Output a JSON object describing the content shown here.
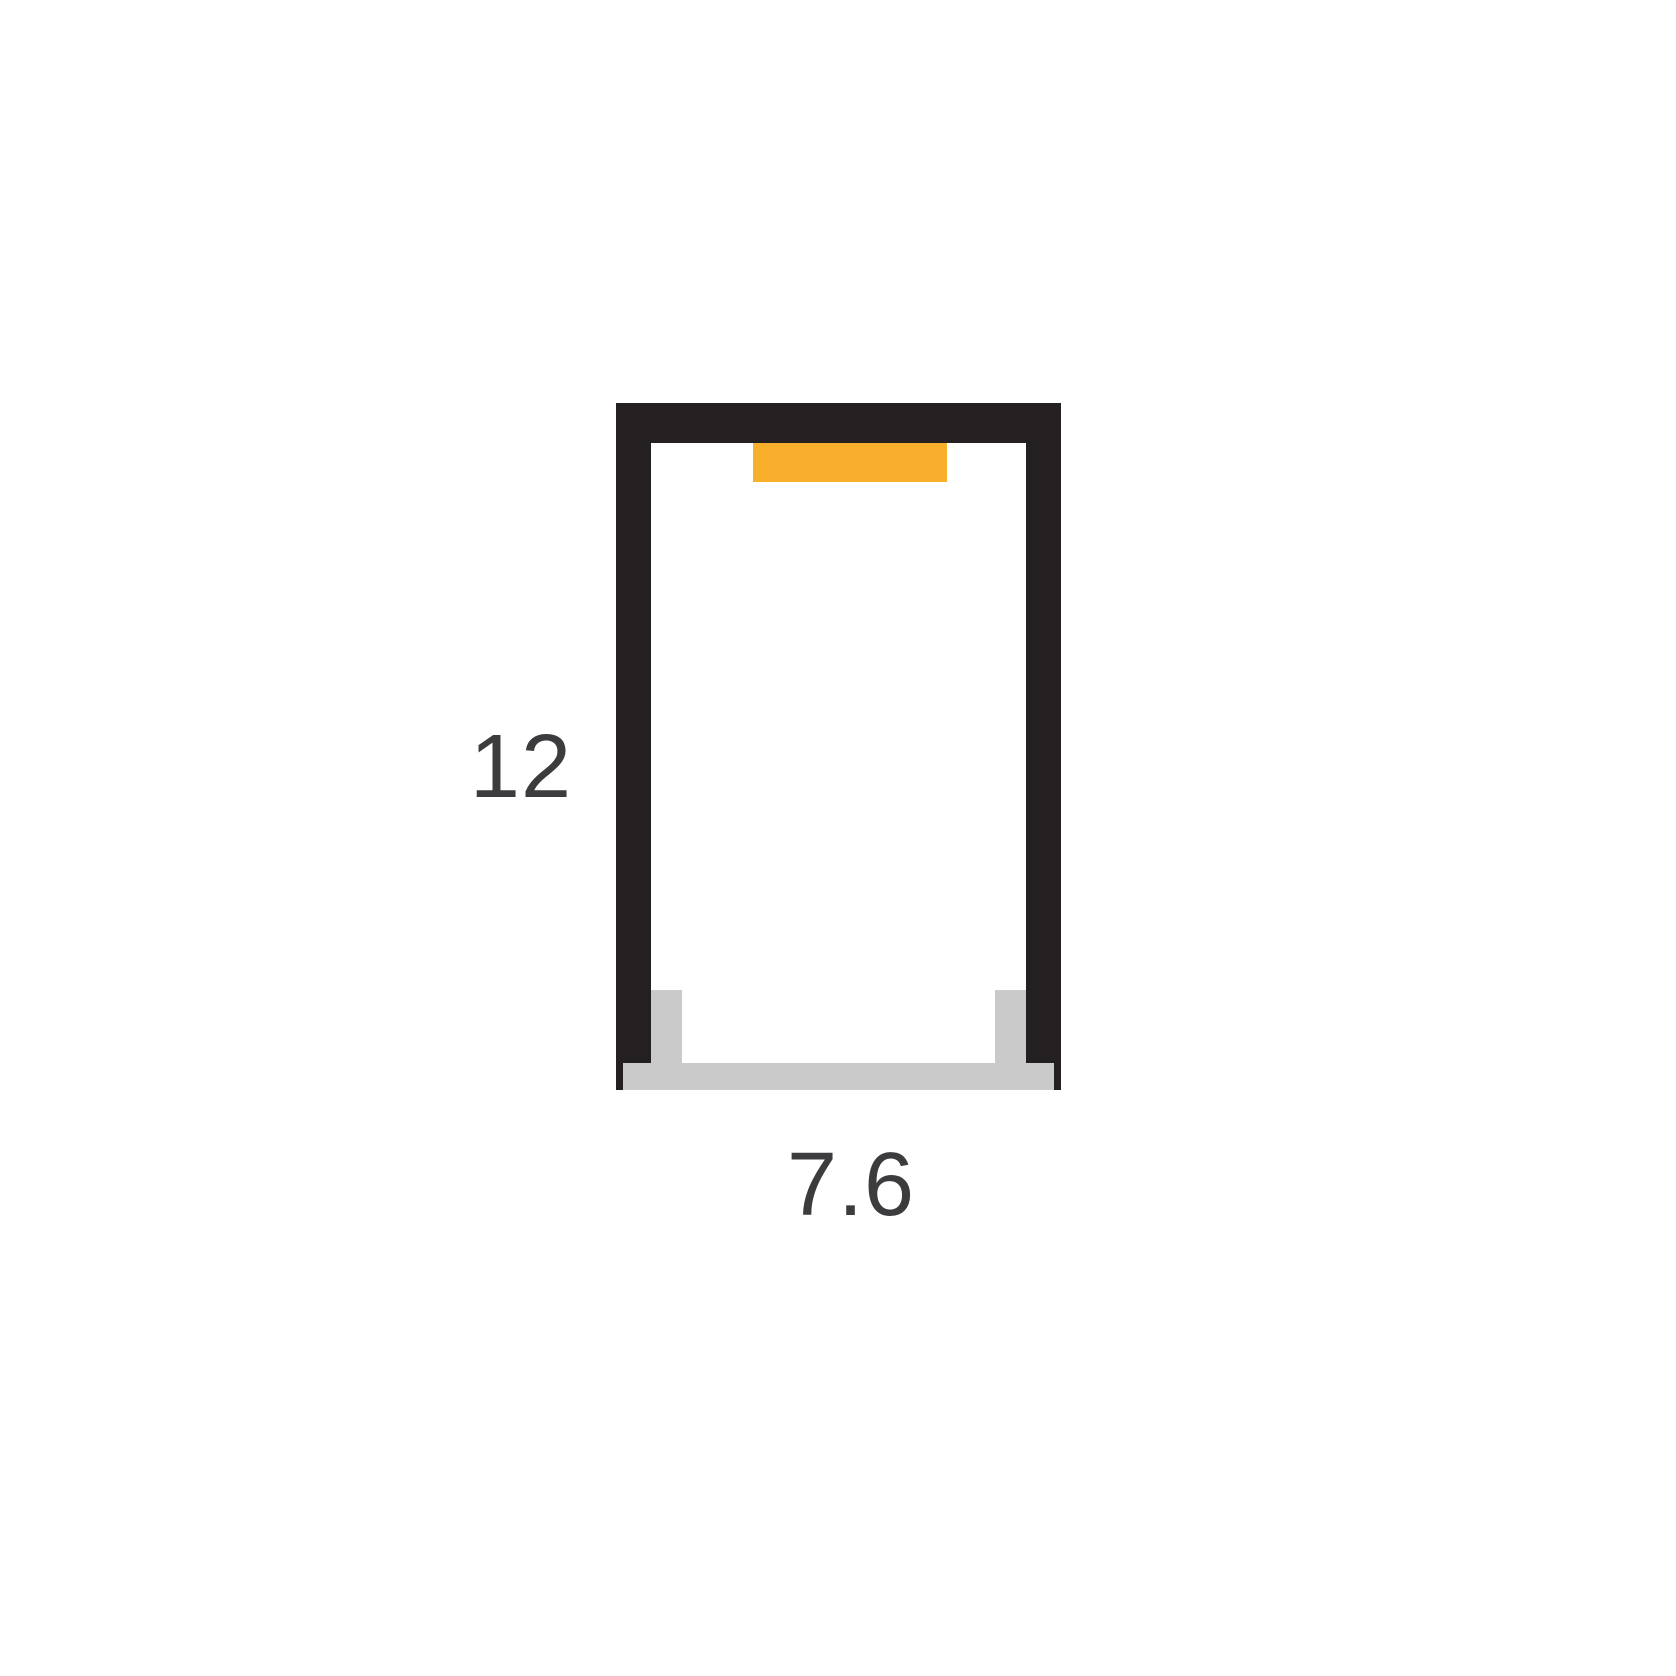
{
  "diagram": {
    "height_label": "12",
    "width_label": "7.6"
  },
  "colors": {
    "housing": "#242021",
    "led_strip": "#F8B02C",
    "diffuser": "#CACACA",
    "label_text": "#3C3C3E",
    "background": "#FFFFFF"
  }
}
